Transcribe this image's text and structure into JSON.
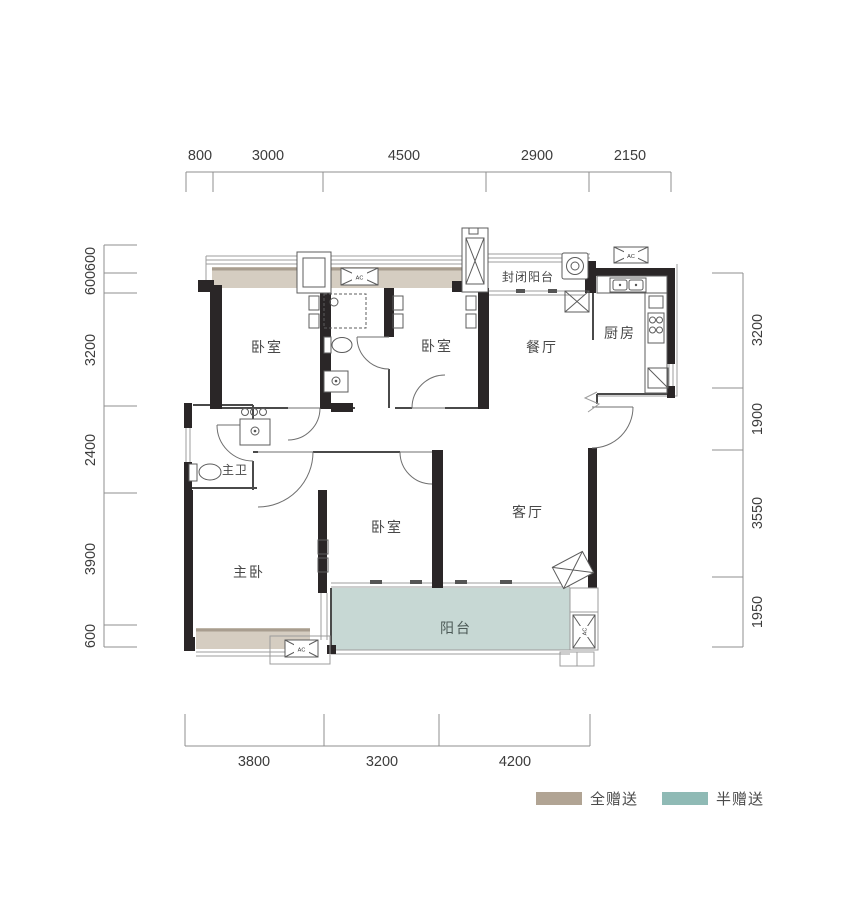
{
  "rooms": {
    "bedroom_top_left": "卧室",
    "bedroom_top_right": "卧室",
    "enclosed_balcony": "封闭阳台",
    "dining": "餐厅",
    "kitchen": "厨房",
    "master_bath": "主卫",
    "master_bedroom": "主卧",
    "bedroom_bottom": "卧室",
    "living": "客厅",
    "balcony": "阳台"
  },
  "dimensions": {
    "top": [
      "800",
      "3000",
      "4500",
      "2900",
      "2150"
    ],
    "left": [
      "600",
      "600",
      "3200",
      "2400",
      "3900",
      "600"
    ],
    "right": [
      "3200",
      "1900",
      "3550",
      "1950"
    ],
    "bottom": [
      "3800",
      "3200",
      "4200"
    ]
  },
  "legend": {
    "full_gift": {
      "label": "全赠送",
      "color": "#b1a494"
    },
    "half_gift": {
      "label": "半赠送",
      "color": "#8fbab5"
    }
  },
  "colors": {
    "full_gift_area": "#d5cdc1",
    "half_gift_area": "#c7d8d4",
    "wall": "#2a2627"
  },
  "ac_unit_label": "AC"
}
